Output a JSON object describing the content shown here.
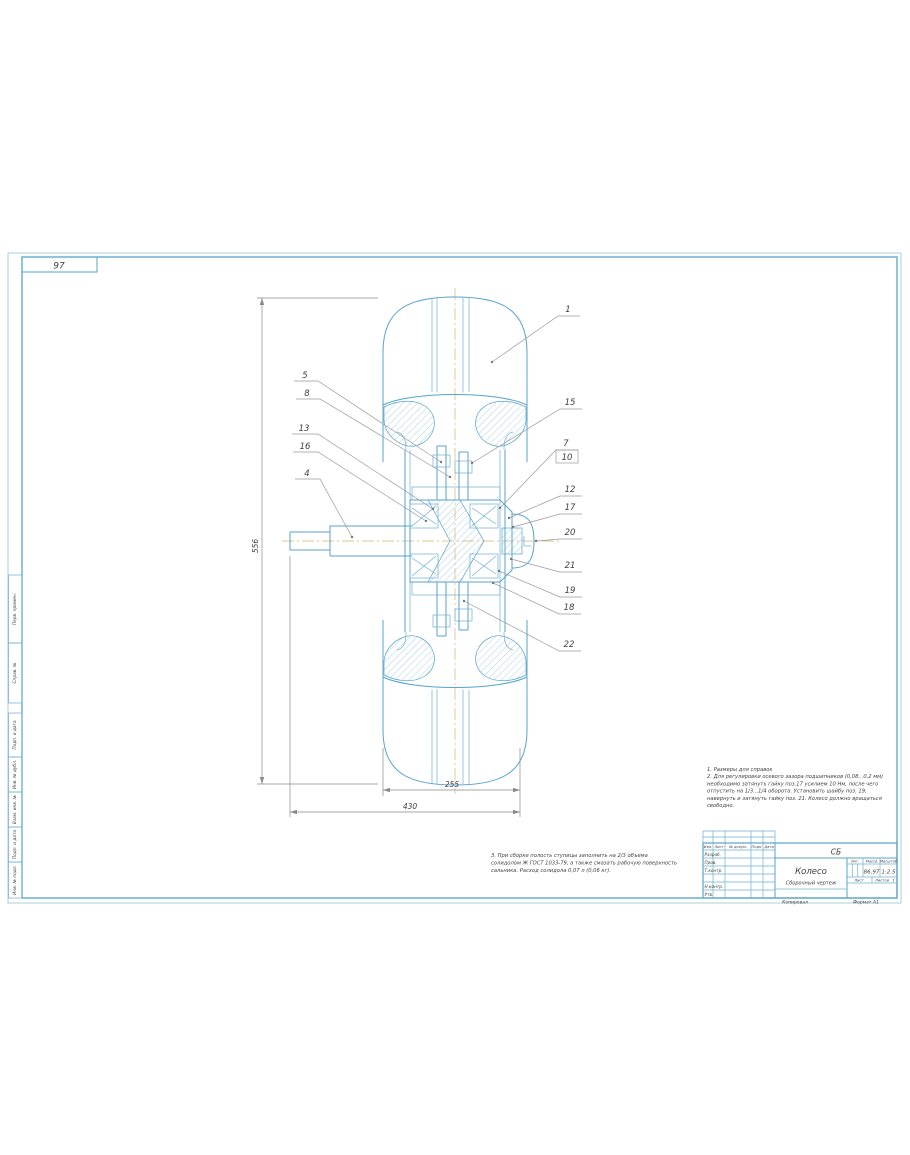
{
  "sheet": {
    "corner_label": "97",
    "copied": "Копировал",
    "format": "Формат   А1"
  },
  "margin_stamps": [
    "Перв. примен.",
    "Справ. №",
    "Подп. и дата",
    "Инв. № дубл.",
    "Взам. инв. №",
    "Подп. и дата",
    "Инв. № подл."
  ],
  "notes_top": {
    "lines": [
      "1. Размеры для справок",
      "2. Для регулировки осевого зазора подшипников (0,08...0,2 мм)",
      "необходимо затянуть гайку поз.17 усилием 10 Нм, после чего",
      "отпустить на 1/3...1/4 оборота. Установить шайбу поз. 19,",
      "навернуть и затянуть гайку поз. 21. Колесо должно вращаться",
      "свободно."
    ]
  },
  "notes_bottom": {
    "lines": [
      "3. При сборке полость ступицы заполнить на 2/3 объема",
      "солидолом Ж ГОСТ 1033-79, а также смазать рабочую поверхность",
      "сальника. Расход солидола 0,07 л (0,06 кг)."
    ]
  },
  "callouts": {
    "left": [
      "5",
      "8",
      "13",
      "16",
      "4"
    ],
    "right": [
      "1",
      "15",
      "7",
      "10",
      "12",
      "17",
      "20",
      "21",
      "19",
      "18",
      "22"
    ]
  },
  "dimensions": {
    "diameter": "556",
    "rim_width": "255",
    "overall_width": "430"
  },
  "title_block": {
    "doc_code": "СБ",
    "title": "Колесо",
    "doc_kind": "Сборочный чертеж",
    "col_headers": [
      "Изм.",
      "Лист",
      "№ докум.",
      "Подп.",
      "Дата"
    ],
    "row_labels": [
      "Разраб.",
      "Пров.",
      "Т.контр.",
      "Н.контр.",
      "Утв."
    ],
    "lit_label": "Лит.",
    "mass_label": "Масса",
    "scale_label": "Масштаб",
    "mass_value": "86,97",
    "scale_value": "1:2.5",
    "sheet_label": "Лист",
    "sheets_label": "Листов",
    "sheets_value": "1"
  },
  "colors": {
    "line": "#56a3ca",
    "centerline": "#e0c48f",
    "leader": "#9a9a9a",
    "text": "#3f3f3f"
  }
}
